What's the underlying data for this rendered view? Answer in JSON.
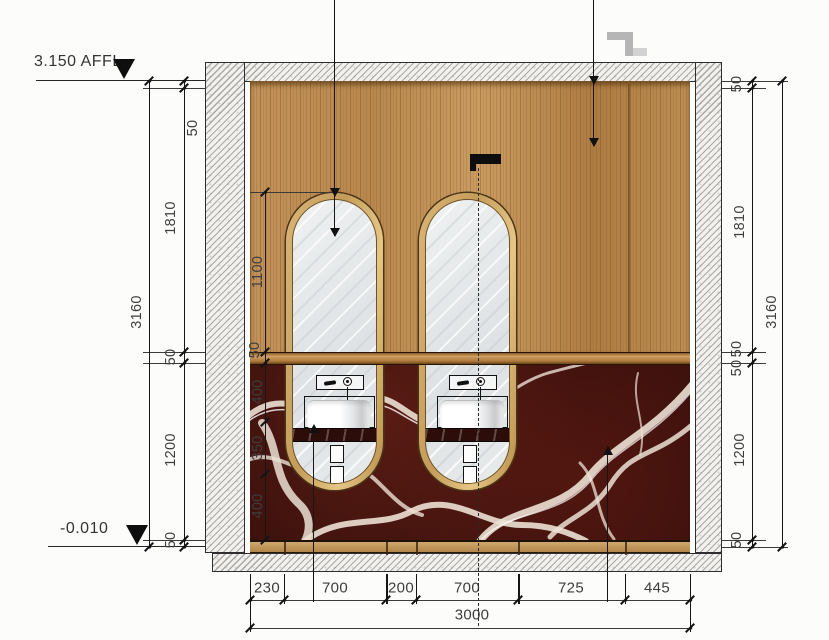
{
  "levels": {
    "top_label": "3.150 AFFL",
    "bottom_label": "-0.010"
  },
  "dimensions": {
    "overall_height": "3160",
    "left_chain": [
      "50",
      "1810",
      "50",
      "1200",
      "50"
    ],
    "right_chain": [
      "50",
      "1810",
      "50",
      "50",
      "1200",
      "50"
    ],
    "overall_width": "3000",
    "bottom_chain": [
      "230",
      "700",
      "200",
      "700",
      "725",
      "445"
    ],
    "mirror_height": "1100",
    "vanity_chain": [
      "50",
      "400",
      "350",
      "400"
    ]
  },
  "materials": {
    "wood_panel": "#bd8e54",
    "marble": "#3a100c",
    "marble_vein": "#ece1d4",
    "mirror_frame_gold": "#c9a360",
    "mirror_glass": "#e4e8ea",
    "hatch_background": "#f2f1ee"
  }
}
